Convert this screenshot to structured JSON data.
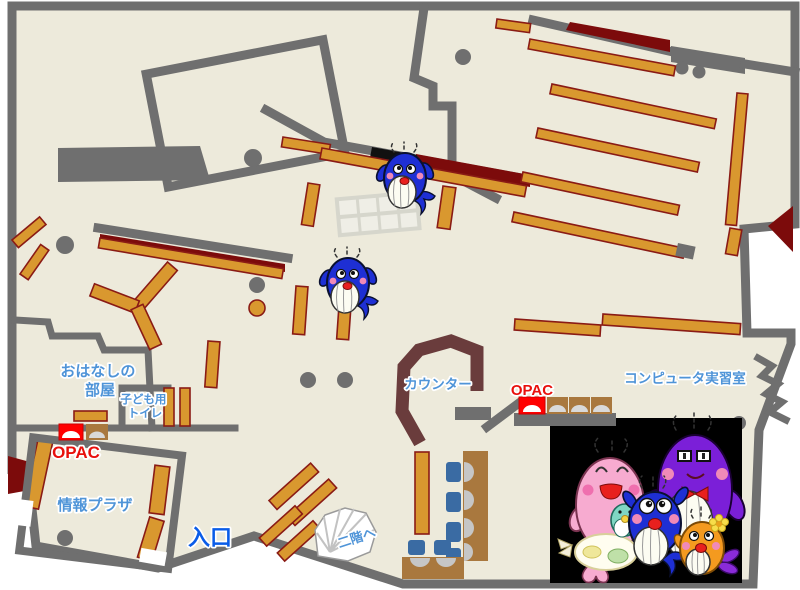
{
  "map": {
    "title_note": "library floor map",
    "labels": {
      "storytelling_room_line1": "おはなしの",
      "storytelling_room_line2": "部屋",
      "kids_toilet_line1": "子ども用",
      "kids_toilet_line2": "トイレ",
      "opac_left": "OPAC",
      "opac_right": "OPAC",
      "info_plaza": "情報プラザ",
      "entrance": "入口",
      "to_second_floor": "二階へ",
      "counter": "カウンター",
      "computer_room": "コンピュータ実習室"
    },
    "colors": {
      "floor": "#edeadb",
      "wall": "#6f6f6f",
      "bookshelf": "#d9982f",
      "bookshelf_outline": "#8a1b15",
      "dark_red_accent": "#7c0b0b",
      "counter": "#6a3c3c",
      "desk": "#a9783e",
      "chair_blue": "#3a6ba3",
      "label_blue": "#4f94d8",
      "entrance_blue": "#0a5ce8",
      "opac_red": "#e8100c",
      "mascot_backdrop": "#000000"
    },
    "mascots": {
      "on_map": [
        "blue-whale-small-upper",
        "blue-whale-small-middle"
      ],
      "family_photo": [
        "purple-whale-parent",
        "pink-whale-parent-with-baby",
        "blue-whale-child",
        "orange-whale-child"
      ]
    }
  }
}
